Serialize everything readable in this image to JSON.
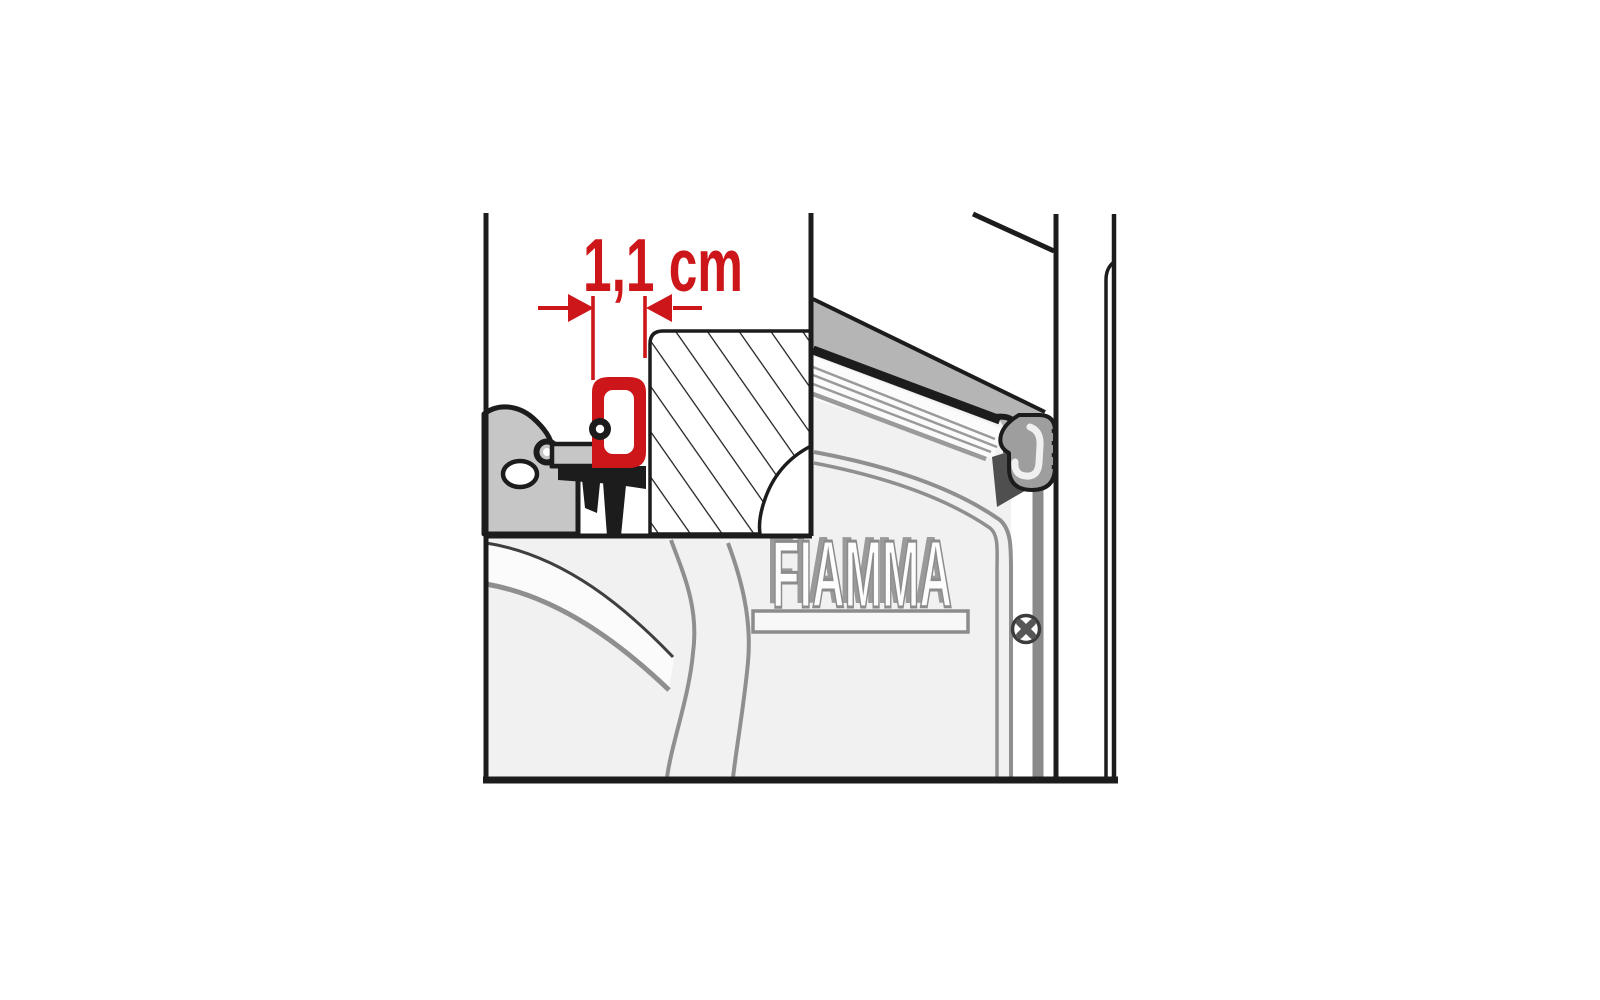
{
  "figure": {
    "type": "technical-illustration",
    "subject": "Awning rain-guard seal cross-section detail over a perspective view of a FIAMMA awning case mounted against a vehicle wall"
  },
  "measurement": {
    "label": "1,1 cm",
    "value_cm": 1.1
  },
  "logo": {
    "text": "FIAMMA"
  },
  "colors": {
    "background": "#ffffff",
    "line_black": "#1c1c1c",
    "accent_red": "#cd1619",
    "case_light_gray": "#f1f1f1",
    "band_gray": "#b5b5b5",
    "rail_gray": "#c6c6c6",
    "seal_gray": "#9e9e9e",
    "detail_gray": "#8f8f8f",
    "bar_gray": "#8a8a8a"
  },
  "icons": [
    {
      "name": "screw-icon",
      "meaning": "cross-head fixing screw on mounting rail"
    }
  ]
}
